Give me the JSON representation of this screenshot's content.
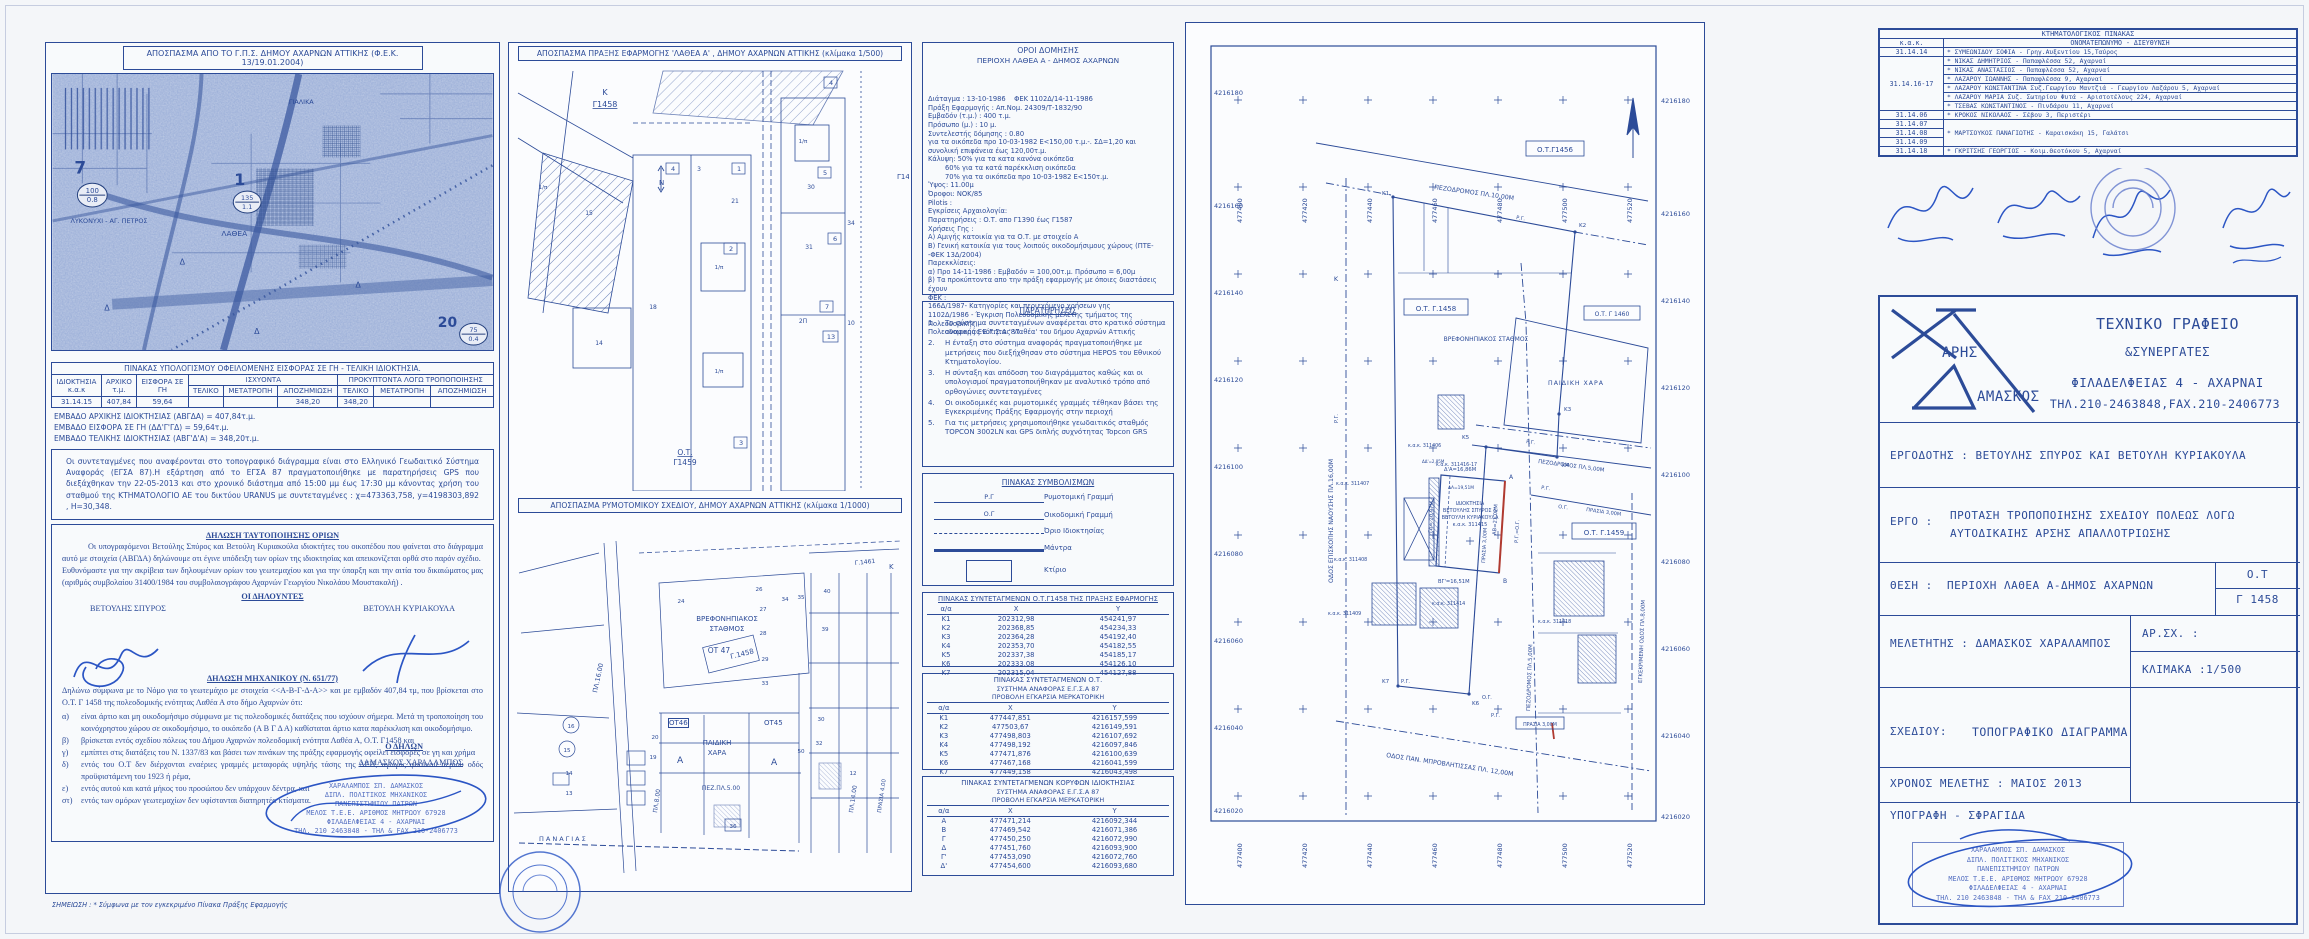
{
  "colors": {
    "ink": "#2c4b98",
    "red": "#b03a30",
    "signature_blue": "#2b55c4"
  },
  "panel1": {
    "title": "ΑΠΟΣΠΑΣΜΑ ΑΠΟ ΤΟ Γ.Π.Σ. ΔΗΜΟΥ ΑΧΑΡΝΩΝ ΑΤΤΙΚΗΣ (Φ.Ε.Κ. 13/19.01.2004)",
    "map": {
      "zone7": "7",
      "zone1": "1",
      "zone20": "20",
      "b100": "100",
      "b08": "0.8",
      "b135": "135",
      "b11": "1.1",
      "b75": "75",
      "b04": "0.4",
      "lathea": "ΛΑΘΕΑ",
      "lykonychi": "ΛΥΚΟΝΥΧΙ - ΑΓ. ΠΕΤΡΟΣ",
      "gialika": "ΓΙΑΛΙΚΑ"
    },
    "etab": {
      "title": "ΠΙΝΑΚΑΣ ΥΠΟΛΟΓΙΣΜΟΥ ΟΦΕΙΛΟΜΕΝΗΣ ΕΙΣΦΟΡΑΣ ΣΕ ΓΗ - ΤΕΛΙΚΗ ΙΔΙΟΚΤΗΣΙΑ.",
      "h1a": "ΙΔΙΟΚΤΗΣΙΑ",
      "h1b": "κ.α.κ",
      "h2a": "ΑΡΧΙΚΟ",
      "h2b": "τ.μ.",
      "h3a": "ΕΙΣΦΟΡΑ ΣΕ",
      "h3b": "ΓΗ",
      "isx": "ΙΣΧΥΟΝΤΑ",
      "pro": "ΠΡΟΚΥΠΤΟΝΤΑ ΛΟΓΩ ΤΡΟΠΟΠΟΙΗΣΗΣ",
      "teliko": "ΤΕΛΙΚΟ",
      "metatropi": "ΜΕΤΑΤΡΟΠΗ",
      "apozimiosi": "ΑΠΟΖΗΜΙΩΣΗ",
      "row": [
        "31.14.15",
        "407,84",
        "59,64",
        "",
        "",
        "348,20",
        "348,20",
        "",
        ""
      ]
    },
    "areas": [
      "ΕΜΒΑΔΟ ΑΡΧΙΚΗΣ ΙΔΙΟΚΤΗΣΙΑΣ (ΑΒΓΔΑ) = 407,84τ.μ.",
      "ΕΜΒΑΔΟ ΕΙΣΦΟΡΑ ΣΕ ΓΗ (ΔΔ'Γ'ΓΔ) = 59,64τ.μ.",
      "ΕΜΒΑΔΟ ΤΕΛΙΚΗΣ ΙΔΙΟΚΤΗΣΙΑΣ (ΑΒΓ'Δ'Α) = 348,20τ.μ."
    ],
    "coords_note": "Οι συντεταγμένες που αναφέρονται στο τοπογραφικό διάγραμμα είναι στο Ελληνικό Γεωδαιτικό Σύστημα Αναφοράς (ΕΓΣΑ 87).Η εξάρτηση από το ΕΓΣΑ 87 πραγματοποιήθηκε με παρατηρήσεις GPS που διεξάχθηκαν την 22-05-2013 και στο χρονικό διάστημα από 15:00 μμ έως 17:30 μμ κάνοντας χρήση του σταθμού της ΚΤΗΜΑΤΟΛΟΓΙΟ ΑΕ  του δικτύου URANUS  με συντεταγμένες : χ=473363,758,   y=4198303,892 ,  Η=30,348.",
    "decl": {
      "title": "ΔΗΛΩΣΗ ΤΑΥΤΟΠΟΙΗΣΗΣ ΟΡΙΩΝ",
      "p1": "Οι υπογραφόμενοι Βετούλης Σπύρος και Βετούλη Κυριακούλα ιδιοκτήτες του οικοπέδου που φαίνεται στο διάγραμμα αυτό με στοιχεία (ΑΒΓΔΑ) δηλώνουμε οτι έγινε υπόδειξη των ορίων της ιδιοκτησίας και απεικονίζεται ορθά στο παρόν σχέδιο.",
      "p2": "Ευθυνόμαστε για την ακρίβεια των δηλουμένων ορίων του γεωτεμαχίου και για την ύπαρξη και την αιτία του δικαιώματος μας (αριθμός συμβολαίου 31400/1984 του συμβολαιογράφου Αχαρνών Γεωργίου Νικολάου Μουστακαλή) .",
      "who": "ΟΙ ΔΗΛΟΥΝΤΕΣ",
      "name_l": "ΒΕΤΟΥΛΗΣ ΣΠΥΡΟΣ",
      "name_r": "ΒΕΤΟΥΛΗ ΚΥΡΙΑΚΟΥΛΑ"
    },
    "eng": {
      "title": "ΔΗΛΩΣΗ ΜΗΧΑΝΙΚΟΥ (Ν. 651/77)",
      "intro": "Δηλώνω σύμφωνα με το Νόμο για το γεωτεμάχιο με στοιχεία <<Α-Β-Γ-Δ-Α>> και με εμβαδόν 407,84 τμ, που βρίσκεται στο Ο.Τ.  Γ 1458 της  πολεοδομικής ενότητας  Λαθέα Α στο δήμο Αχαρνών ότι:",
      "items": [
        {
          "n": "α)",
          "t": "είναι άρτιο και μη οικοδομήσιμο σύμφωνα με τις πολεοδομικές διατάξεις που ισχύουν σήμερα. Μετά τη τροποποίηση του κοινόχρηστου χώρου σε οικοδομήσιμο, το οικόπεδο (Α Β Γ Δ Α) καθίσταται άρτιο κατα παρέκκλιση και οικοδομήσιμο."
        },
        {
          "n": "β)",
          "t": "βρίσκεται εντός σχεδίου πόλεως του Δήμου Αχαρνών πολεοδομική ενότητα Λαθέα Α, Ο.Τ. Γ1458 και"
        },
        {
          "n": "γ)",
          "t": "εμπίπτει στις διατάξεις του Ν. 1337/83 και βάσει των πινάκων της πράξης εφαρμογής οφείλει εισφορές σε γη και χρήμα"
        },
        {
          "n": "δ)",
          "t": "εντός του Ο.Τ δεν διέρχονται εναέριες γραμμές μεταφοράς υψηλής τάσης της ΔΕΗ, αγωγός φυσικού αερίου οδός προϋφιστάμενη του 1923 ή ρέμα,"
        },
        {
          "n": "ε)",
          "t": "εντός αυτού και κατά μήκος του προσώπου  δεν υπάρχουν δέντρα, και"
        },
        {
          "n": "στ)",
          "t": "εντός των ομόρων γεωτεμαχίων δεν υφίστανται διατηρητέα κτίσματα."
        }
      ],
      "who": "Ο ΔΗΛΩΝ",
      "name": "ΔΑΜΑΣΚΟΣ ΧΑΡΑΛΑΜΠΟΣ"
    },
    "footnote": "ΣΗΜΕΙΩΣΗ : * Σύμφωνα με τον εγκεκριμένο Πίνακα Πράξης Εφαρμογής"
  },
  "stamp_lines": [
    "ΧΑΡΑΛΑΜΠΟΣ ΣΠ. ΔΑΜΑΣΚΟΣ",
    "ΔΙΠΛ. ΠΟΛΙΤΙΚΟΣ ΜΗΧΑΝΙΚΟΣ",
    "ΠΑΝΕΠΙΣΤΗΜΙΟΥ ΠΑΤΡΩΝ",
    "ΜΕΛΟΣ Τ.Ε.Ε. ΑΡΙΘΜΟΣ ΜΗΤΡΩΟΥ 67928",
    "ΦΙΛΑΔΕΛΦΕΙΑΣ 4 - ΑΧΑΡΝΑΙ",
    "ΤΗΛ. 210 2463848 - ΤΗΛ & FAX 210-2406773"
  ],
  "panel2": {
    "title_pe": "ΑΠΟΣΠΑΣΜΑ ΠΡΑΞΗΣ ΕΦΑΡΜΟΓΗΣ 'ΛΑΘΕΑ Α' , ΔΗΜΟΥ ΑΧΑΡΝΩΝ ΑΤΤΙΚΗΣ (κλίμακα 1/500)",
    "title_rym": "ΑΠΟΣΠΑΣΜΑ ΡΥΜΟΤΟΜΙΚΟΥ ΣΧΕΔΙΟΥ,  ΔΗΜΟΥ ΑΧΑΡΝΩΝ ΑΤΤΙΚΗΣ  (κλίμακα 1/1000)",
    "d1": {
      "k": "Κ",
      "g1458": "Γ1458",
      "ot": "Ο.Τ.",
      "g1459": "Γ1459",
      "n": "Ν",
      "g14": "Γ14",
      "boxnums": [
        "4",
        "1",
        "2",
        "3",
        "4",
        "5",
        "6",
        "7",
        "13"
      ],
      "nums": [
        "3",
        "21",
        "30",
        "31",
        "34",
        "14",
        "15",
        "18",
        "10",
        "2Π"
      ],
      "yp": [
        "1/π",
        "1/π",
        "1/π",
        "1/π"
      ]
    },
    "d2": {
      "vref1": "ΒΡΕΦΟΝΗΠΙΑΚΟΣ",
      "vref2": "ΣΤΑΘΜΟΣ",
      "ot47": "ΟΤ 47",
      "g1458": "Γ.1458",
      "paidiki1": "ΠΑΙΔΙΚΗ",
      "paidiki2": "ΧΑΡΑ",
      "pez5": "ΠΕΖ.ΠΛ.5.00",
      "pl16": "ΠΛ.16.00",
      "ot46": "ΟΤ46",
      "ot45": "ΟΤ45",
      "a1": "Α",
      "a2": "Α",
      "g1461": "Γ.1461",
      "k": "Κ",
      "panagias": "ΠΑΝΑΓΙΑΣ",
      "pl8": "ΠΛ.8.00",
      "pl14": "ΠΛ.14.00",
      "prasia4": "ΠΡΑΣΙΑ 4.00",
      "nums": [
        "24",
        "26",
        "27",
        "28",
        "29",
        "33",
        "34",
        "35",
        "40",
        "39",
        "30",
        "32",
        "20",
        "19",
        "16",
        "15",
        "14",
        "13",
        "12",
        "36",
        "50"
      ]
    }
  },
  "panel3": {
    "oroi": {
      "t1": "ΟΡΟΙ ΔΟΜΗΣΗΣ",
      "t2": "ΠΕΡΙΟΧΗ  ΛΑΘΕΑ Α - ΔΗΜΟΣ ΑΧΑΡΝΩΝ",
      "lines": [
        "Διάταγμα : 13-10-1986    ΦΕΚ 1102Δ/14-11-1986",
        "Πράξη Εφαρμογής : Απ.Νομ. 24309/Τ-1832/90",
        "Εμβαδόν (τ.μ.) : 400 τ.μ.",
        "Πρόσωπο (μ.) : 10 μ.",
        "Συντελεστής δόμησης : 0.80",
        "για τα οικόπεδα προ 10-03-1982 Ε<150,00 τ.μ.-. ΣΔ=1,20 και",
        "συνολική επιφάνεια έως 120,00τ.μ.",
        "Κάλυψη: 50% για τα κατα κανόνα οικόπεδα",
        "        60% για τα κατά παρέκκλιση οικόπεδα",
        "        70% για τα οικόπεδα προ 10-03-1982 Ε<150τ.μ.",
        "Ύψος: 11.00μ",
        "Όροφοι: ΝΟΚ/85",
        "Pilotis :",
        "Εγκρίσεις Αρχαιολογία:",
        "Παρατηρήσεις : Ο.Τ. απο Γ1390 έως Γ1587",
        "Χρήσεις Γης :",
        "Α) Αμιγής κατοικία για τα Ο.Τ. με στοιχείο Α",
        "Β) Γενική κατοικία για τους λοιπούς οικοδομήσιμους χώρους (ΠΤΕ-",
        "-ΦΕΚ 13Δ/2004)",
        "Παρεκκλίσεις:",
        "α) Προ 14-11-1986 : Εμβαδόν = 100,00τ.μ. Πρόσωπο = 6,00μ",
        "β) Τα προκύπτοντα απο την πράξη εφαρμογής με όποιες διαστάσεις έχουν",
        "ΦΕΚ :",
        "166Δ/1987- Κατηγορίες και περιεχόμενο χρήσεων γης",
        "1102Δ/1986 - Έγκριση Πολεοδομικής μελέτης τμήματος της Πολεοδομικής",
        "Πολεοδομικής Ενότητας 'Λαθέα' του δήμου Αχαρνών Αττικής"
      ]
    },
    "para": {
      "title": "ΠΑΡΑΤΗΡΗΣΕΙΣ",
      "items": [
        {
          "n": "1.",
          "t": "Το σύστημα συντεταγμένων αναφέρεται στο κρατικό σύστημα αναφοράς Ε.Γ.Σ.Α '87"
        },
        {
          "n": "2.",
          "t": "Η ένταξη στο σύστημα αναφοράς πραγματοποιήθηκε με μετρήσεις που διεξήχθησαν στο σύστημα HEPOS του Εθνικού Κτηματολογίου."
        },
        {
          "n": "3.",
          "t": "Η σύνταξη και απόδοση του διαγράμματος καθώς και οι υπολογισμοί πραγματοποιήθηκαν με αναλυτικό τρόπο από ορθογώνιες συντεταγμένες"
        },
        {
          "n": "4.",
          "t": "Οι οικοδομικές και ρυμοτομικές γραμμές τέθηκαν βάσει της Εγκεκριμένης Πράξης Εφαρμογής στην περιοχή"
        },
        {
          "n": "5.",
          "t": "Για τις μετρήσεις χρησιμοποιήθηκε γεωδαιτικός σταθμός TOPCON 3002LN και GPS διπλής συχνότητας Topcon GRS"
        }
      ]
    },
    "sym": {
      "title": "ΠΙΝΑΚΑΣ ΣΥΜΒΟΛΙΣΜΩΝ",
      "rg": "Ρ.Γ",
      "og": "Ο.Γ",
      "lab_rg": "Ρυμοτομική Γραμμή",
      "lab_og": "Οικοδομική Γραμμή",
      "lab_orio": "Όριο Ιδιοκτησίας",
      "lab_mantra": "Μάντρα",
      "lab_ktirio": "Κτίριο"
    },
    "t1": {
      "title": "ΠΙΝΑΚΑΣ ΣΥΝΤΕΤΑΓΜΕΝΩΝ Ο.Τ.Γ1458 ΤΗΣ ΠΡΑΞΗΣ ΕΦΑΡΜΟΓΗΣ",
      "headers": [
        "α/α",
        "Χ",
        "Υ"
      ],
      "rows": [
        [
          "Κ1",
          "202312,98",
          "454241,97"
        ],
        [
          "Κ2",
          "202368,85",
          "454234,33"
        ],
        [
          "Κ3",
          "202364,28",
          "454192,40"
        ],
        [
          "Κ4",
          "202353,70",
          "454182,55"
        ],
        [
          "Κ5",
          "202337,38",
          "454185,17"
        ],
        [
          "Κ6",
          "202333,08",
          "454126,10"
        ],
        [
          "Κ7",
          "202315,04",
          "454127,88"
        ]
      ]
    },
    "t2": {
      "title_lines": [
        "ΠΙΝΑΚΑΣ ΣΥΝΤΕΤΑΓΜΕΝΩΝ Ο.Τ.",
        "ΣΥΣΤΗΜΑ ΑΝΑΦΟΡΑΣ Ε.Γ.Σ.Α 87",
        "ΠΡΟΒΟΛΗ ΕΓΚΑΡΣΙΑ ΜΕΡΚΑΤΟΡΙΚΗ"
      ],
      "headers": [
        "α/α",
        "Χ",
        "Υ"
      ],
      "rows": [
        [
          "Κ1",
          "477447,851",
          "4216157,599"
        ],
        [
          "Κ2",
          "477503,67",
          "4216149,591"
        ],
        [
          "Κ3",
          "477498,803",
          "4216107,692"
        ],
        [
          "Κ4",
          "477498,192",
          "4216097,846"
        ],
        [
          "Κ5",
          "477471,876",
          "4216100,639"
        ],
        [
          "Κ6",
          "477467,168",
          "4216041,599"
        ],
        [
          "Κ7",
          "477449,158",
          "4216043,498"
        ]
      ]
    },
    "t3": {
      "title_lines": [
        "ΠΙΝΑΚΑΣ ΣΥΝΤΕΤΑΓΜΕΝΩΝ ΚΟΡΥΦΩΝ ΙΔΙΟΚΤΗΣΙΑΣ",
        "ΣΥΣΤΗΜΑ ΑΝΑΦΟΡΑΣ Ε.Γ.Σ.Α 87",
        "ΠΡΟΒΟΛΗ ΕΓΚΑΡΣΙΑ ΜΕΡΚΑΤΟΡΙΚΗ"
      ],
      "headers": [
        "α/α",
        "Χ",
        "Υ"
      ],
      "rows": [
        [
          "Α",
          "477471,214",
          "4216092,344"
        ],
        [
          "Β",
          "477469,542",
          "4216071,386"
        ],
        [
          "Γ",
          "477450,250",
          "4216072,990"
        ],
        [
          "Δ",
          "477451,760",
          "4216093,900"
        ],
        [
          "Γ'",
          "477453,090",
          "4216072,760"
        ],
        [
          "Δ'",
          "477454,600",
          "4216093,680"
        ]
      ]
    }
  },
  "site_plan": {
    "x_ticks": [
      "477400",
      "477420",
      "477440",
      "477460",
      "477480",
      "477500",
      "477520"
    ],
    "y_ticks": [
      "4216180",
      "4216160",
      "4216140",
      "4216120",
      "4216100",
      "4216080",
      "4216060",
      "4216040",
      "4216020"
    ],
    "ot1456": "Ο.Τ.Γ1456",
    "ot1458": "Ο.Τ. Γ.1458",
    "ot1459": "Ο.Τ. Γ.1459",
    "ot1460": "Ο.Τ. Γ 1460",
    "st_pez10": "ΠΕΖΟΔΡΟΜΟΣ ΠΛ.10,00Μ",
    "st_episkopis": "ΟΔΟΣ ΕΠΙΣΚΟΠΗΣ ΝΑΟΥΣΗΣ ΠΛ.16,00Μ",
    "st_brovl": "ΟΔΟΣ ΠΑΝ. ΜΠΡΟΒΛΗΤΙΣΣΑΣ ΠΛ. 12,00Μ",
    "st_pez5h": "ΠΕΖΟΔΡΟΜΟΣ ΠΛ.5,00Μ",
    "st_pez5v": "ΠΕΖΟΔΡΟΜΟΣ ΠΛ.5,00Μ",
    "st_egkekrimeni": "ΕΓΚΕΚΡΙΜΕΝΗ ΟΔΟΣ ΠΛ.8,00Μ",
    "prasia": "ΠΡΑΣΙΑ 3,00Μ",
    "vrefonipiakos": "ΒΡΕΦΟΝΗΠΙΑΚΟΣ ΣΤΑΘΜΟΣ",
    "paidiki_chara": "ΠΑΙΔΙΚΗ ΧΑΡΑ",
    "prop": [
      "ΙΔΙΟΚΤΗΣΙΑ",
      "ΒΕΤΟΥΛΗΣ ΣΠΥΡΟΣ &",
      "ΒΕΤΟΥΛΗ ΚΥΡΙΑΚΟΥΛΑ",
      "κ.α.κ. 311415"
    ],
    "kak": [
      "κ.α.κ. 311406",
      "κ.α.κ. 311416-17",
      "κ.α.κ. 311407",
      "κ.α.κ. 311408",
      "κ.α.κ. 311409",
      "κ.α.κ. 311414",
      "κ.α.κ. 311418"
    ],
    "dims": {
      "d_a": "Δ'Α=16,86Μ",
      "da": "ΔΑ=19,51Μ",
      "dd": "ΔΔ'=2,85Μ",
      "ab": "ΑΒ=21,02Μ",
      "bg": "ΒΓ'=16,51Μ",
      "gd": "ΓΔ= 20,97Μ"
    },
    "verts": [
      "Κ1",
      "Κ2",
      "Κ3",
      "Κ4",
      "Κ5",
      "Κ6",
      "Κ7"
    ],
    "pa": "Α",
    "pb": "Β",
    "pk": "Κ",
    "rg": "Ρ.Γ.",
    "og": "Ο.Γ.",
    "rgog": "Ρ.Γ.=Ο.Γ."
  },
  "ktim": {
    "title": "ΚΤΗΜΑΤΟΛΟΓΙΚΟΣ ΠΙΝΑΚΑΣ",
    "h_kak": "κ.α.κ.",
    "h_name": "ΟΝΟΜΑΤΕΠΩΝΥΜΟ - ΔΙΕΥΘΥΝΣΗ",
    "groups": [
      {
        "kak": "31.14.14",
        "names": [
          "* ΣΥΜΕΩΝΙΔΟΥ ΣΟΦΙΑ - Γρηγ.Αυξεντίου 15,Ταύρος"
        ]
      },
      {
        "kak": "31.14.16-17",
        "names": [
          "* ΝΙΚΑΣ ΔΗΜΗΤΡΙΟΣ - Παπαφλέσσα 52, Αχαρναί",
          "* ΝΙΚΑΣ ΑΝΑΣΤΑΣΙΟΣ - Παπαφλέσσα 52, Αχαρναί",
          "* ΛΑΖΑΡΟΥ ΙΩΑΝΝΗΣ - Παπαφλέσσα 9, Αχαρναί",
          "* ΛΑΖΑΡΟΥ ΚΩΝΣΤΑΝΤΙΝΑ Συζ.Γεωργίου Μαντζιά - Γεωργίου Λαζάρου 5, Αχαρναί",
          "* ΛΑΖΑΡΟΥ ΜΑΡΙΑ Συζ. Σωτηρίου Φυτά - Αριστοτέλους 224, Αχαρναί",
          "* ΤΣΕΒΑΣ ΚΩΝΣΤΑΝΤΙΝΟΣ - Πινδάρου 11, Αχαρναί"
        ]
      },
      {
        "kak": "31.14.06",
        "names": [
          "* ΚΡΟΚΟΣ ΝΙΚΟΛΑΟΣ - Σέβου 3, Περιστέρι"
        ]
      },
      {
        "kak_lines": [
          "31.14.07",
          "31.14.08",
          "31.14.09"
        ],
        "names": [
          "* ΜΑΡΤΣΟΥΚΟΣ ΠΑΝΑΓΙΩΤΗΣ - Καραισκάκη 15, Γαλάτσι"
        ]
      },
      {
        "kak": "31.14.18",
        "names": [
          "* ΓΚΡΙΤΣΗΣ ΓΕΩΡΓΙΟΣ - Κοιμ.Θεοτόκου 5, Αχαρναί"
        ]
      }
    ]
  },
  "tb": {
    "logo_top": "ΑΡΗΣ",
    "logo_bottom": "ΑΜΑΣΚΟΣ",
    "office1": "ΤΕΧΝΙΚΟ  ΓΡΑΦΕΙΟ",
    "office2": "&ΣΥΝΕΡΓΑΤΕΣ",
    "office3": "ΦΙΛΑΔΕΛΦΕΙΑΣ 4 - ΑΧΑΡΝΑΙ",
    "office4": "ΤΗΛ.210-2463848,FAX.210-2406773",
    "ergod_l": "ΕΡΓΟΔΟΤΗΣ :",
    "ergod": "ΒΕΤΟΥΛΗΣ ΣΠΥΡΟΣ ΚΑΙ ΒΕΤΟΥΛΗ ΚΥΡΙΑΚΟΥΛΑ",
    "ergo_l": "ΕΡΓΟ :",
    "ergo1": "ΠΡΟΤΑΣΗ  ΤΡΟΠΟΠΟΙΗΣΗΣ ΣΧΕΔΙΟΥ ΠΟΛΕΩΣ ΛΟΓΩ",
    "ergo2": "ΑΥΤΟΔΙΚΑΙΗΣ ΑΡΣΗΣ ΑΠΑΛΛΟΤΡΙΩΣΗΣ",
    "thesi_l": "ΘΕΣΗ :",
    "thesi": "ΠΕΡΙΟΧΗ ΛΑΘΕΑ Α-ΔΗΜΟΣ ΑΧΑΡΝΩΝ",
    "ot_l": "Ο.Τ",
    "ot_v": "Γ 1458",
    "melet_l": "ΜΕΛΕΤΗΤΗΣ :",
    "melet": "ΔΑΜΑΣΚΟΣ ΧΑΡΑΛΑΜΠΟΣ",
    "arsx": "ΑΡ.ΣΧ. :",
    "klimaka": "ΚΛΙΜΑΚΑ :1/500",
    "sxed_l": "ΣΧΕΔΙΟΥ:",
    "sxed": "ΤΟΠΟΓΡΑΦΙΚΟ ΔΙΑΓΡΑΜΜΑ",
    "xronos": "ΧΡΟΝΟΣ ΜΕΛΕΤΗΣ : ΜΑΙΟΣ   2013",
    "ypografi": "ΥΠΟΓΡΑΦΗ  -  ΣΦΡΑΓΙΔΑ"
  }
}
